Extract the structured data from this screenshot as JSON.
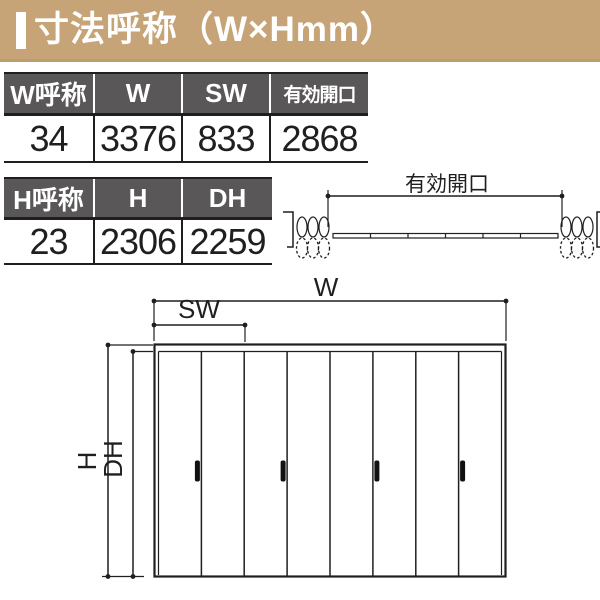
{
  "header": {
    "title": "寸法呼称（W×Hmm）"
  },
  "width_table": {
    "headers": [
      "W呼称",
      "W",
      "SW",
      "有効開口"
    ],
    "values": [
      "34",
      "3376",
      "833",
      "2868"
    ]
  },
  "height_table": {
    "headers": [
      "H呼称",
      "H",
      "DH"
    ],
    "values": [
      "23",
      "2306",
      "2259"
    ]
  },
  "plan_view": {
    "opening_label": "有効開口"
  },
  "front_view": {
    "width_label": "W",
    "slide_width_label": "SW",
    "height_label": "H",
    "door_height_label": "DH",
    "panel_count": 8
  },
  "colors": {
    "band_bg": "#c6a478",
    "table_header_bg": "#595757",
    "line": "#1f1f1f"
  }
}
